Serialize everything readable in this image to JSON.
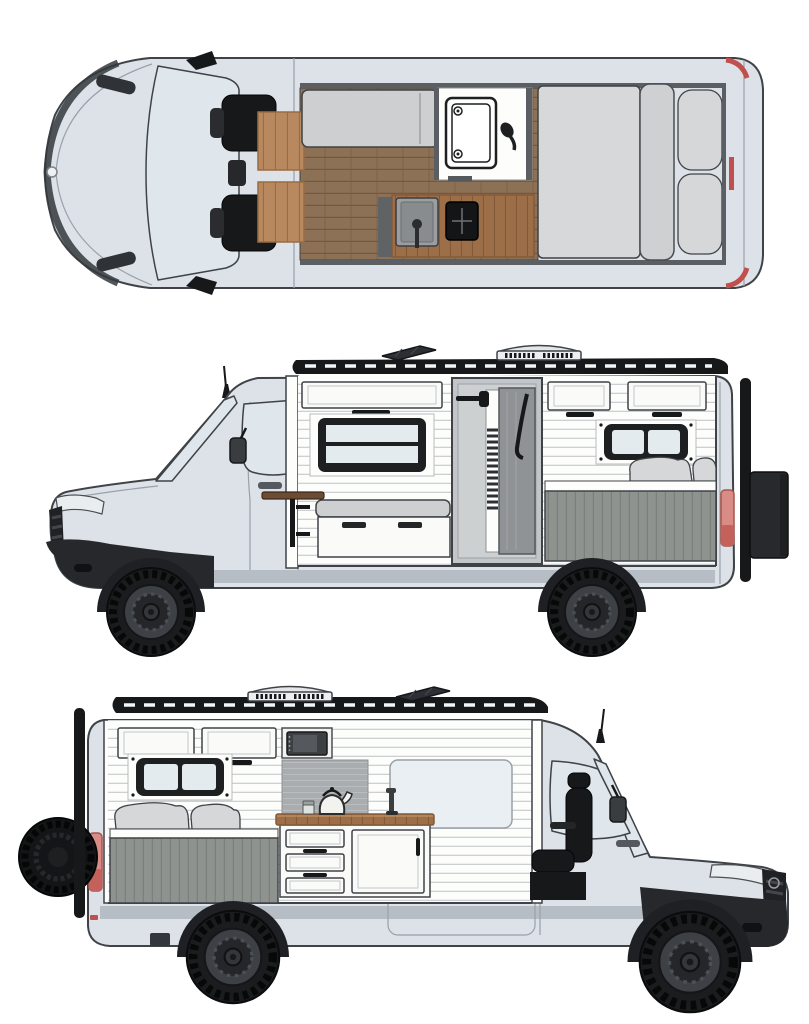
{
  "page": {
    "background": "#ffffff"
  },
  "views": {
    "top": {
      "label": "van-top-floorplan-view"
    },
    "driver_side": {
      "label": "van-driver-side-cutaway-view"
    },
    "passenger_side": {
      "label": "van-passenger-side-cutaway-view"
    }
  },
  "parts": {
    "top": [
      "cab-seats",
      "dinette-tables",
      "bench-sofa",
      "shower-room",
      "handheld-shower",
      "kitchen-sink",
      "cooktop",
      "kitchen-counter",
      "wood-floor",
      "bed-mattress",
      "pillows",
      "side-mirrors"
    ],
    "driver_side": [
      "roof-rack",
      "roof-fan",
      "solar-panel",
      "antenna",
      "upper-cabinets",
      "awning-window",
      "bench-seat",
      "wall-table",
      "shower-stall",
      "bedroom-window",
      "bed-pillows",
      "garage-panel",
      "tail-light",
      "rear-storage-box",
      "rear-ladder",
      "wheels"
    ],
    "passenger_side": [
      "roof-rack",
      "roof-fan",
      "solar-panel",
      "antenna",
      "spare-tire",
      "rear-ladder",
      "tail-light",
      "upper-cabinets",
      "microwave",
      "bedroom-window",
      "bed-pillows",
      "garage-panel",
      "backsplash",
      "kitchen-drawers",
      "kitchen-cabinet",
      "countertop",
      "kettle",
      "jar",
      "faucet",
      "sliding-door-window",
      "passenger-seat",
      "wheels"
    ]
  },
  "colors": {
    "outline": "#3f4347",
    "body": "#dde2e9",
    "rocker": "#b7bdc5",
    "glass": "#dfe7ec",
    "glass_light": "#e9eff3",
    "black_trim": "#17181a",
    "bumper": "#26282b",
    "interior_white": "#fdfdfc",
    "shiplap_line": "#cdd0d2",
    "cabinet_face": "#fafaf8",
    "window_frame": "#1d1f21",
    "pane": "#e4ebef",
    "cushion": "#cdcfd0",
    "pillow": "#d6d7d8",
    "mattress": "#d7d8d9",
    "garage": "#8e938f",
    "garage_line": "#7b807c",
    "floor_wood": "#8d7157",
    "floor_line": "#74593f",
    "counter_wood": "#9c6f49",
    "counter_line": "#835a39",
    "table_wood": "#6e4b33",
    "box_wood": "#b8895e",
    "box_wood_line": "#996c44",
    "backsplash": "#aaadb0",
    "backsplash_line": "#b9bdc0",
    "steel": "#8f9396",
    "shower_panel": "#c3c6c8",
    "sink_steel": "#9a9ea0",
    "tail_light": "#d98c86",
    "tail_dark": "#c4615b",
    "red_accent": "#c0504d",
    "wheel_tire": "#1a1c1e",
    "wheel_rim": "#3d4044",
    "seat_black": "#17181a"
  }
}
